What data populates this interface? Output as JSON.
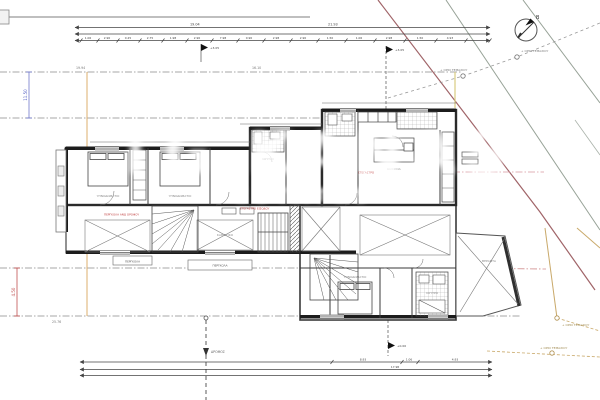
{
  "watermark": {
    "line1": "TG KANAS",
    "line2": "ESTATES"
  },
  "north": {
    "label": "Β"
  },
  "dims_top": {
    "total_left": "19.04",
    "total_right": "21.93",
    "segments": [
      "1.06",
      "2.90",
      "0.25",
      "2.75",
      "1.98",
      "2.90",
      "7.98",
      "0.90",
      "2.98",
      "2.90",
      "1.50",
      "1.06",
      "2.98",
      "1.50",
      "4.93"
    ]
  },
  "dims_bottom": {
    "seg1": "8.93",
    "seg2": "1.06",
    "seg3": "4.93",
    "total": "17.98"
  },
  "dims_side": {
    "blue_left": "11.50",
    "red_left": "4.50",
    "aux1": "19.94",
    "aux2": "16.10",
    "aux3": "25.76"
  },
  "levels": {
    "m1": "+3.05",
    "m2": "+3.05",
    "m3": "+0.00"
  },
  "boundary": {
    "node1": "+ ΟΡΙΟ ΤΕΜΑΧΙΟΥ",
    "node2": "+ ΟΡΙΟ ΤΕΜΑΧΙΟΥ",
    "node3": "+ ΟΡΙΟ ΤΕΜΑΧΙΟΥ",
    "node4": "+ ΟΡΙΟ ΤΕΜΑΧΙΟΥ"
  },
  "road": {
    "label": "ΔΡΟΜΟΣ"
  },
  "pergolas": {
    "p1": "ΠΕΡΓΚΟΛΑ",
    "p2": "ΠΕΡΓΚΟΛΑ"
  },
  "red_notes": {
    "n1": "ΠΕΡΓΚΟΛΑ ΑΝΩ ΟΡΟΦΟΥ",
    "n2": "ΣΤΕΓΑΣΤΡΟ",
    "n3": "ΣΤΕΓΑΣΤΡΟ ΕΙΣΟΔΟΥ"
  },
  "rooms": {
    "r1": "ΥΠΝΟΔΩΜΑΤΙΟ",
    "r2": "ΥΠΝΟΔΩΜΑΤΙΟ",
    "r3": "ΛΟΥΤΡΟ",
    "r4": "ΚΟΥΖΙΝΑ",
    "r5": "ΚΑΘΙΣΤΙΚΟ",
    "r6": "ΥΠΝΟΔΩΜΑΤΙΟ",
    "r7": "ΛΟΥΤΡΟ",
    "r8": "ΒΕΡΑΝΤΑ"
  },
  "colors": {
    "boundary_red": "#a06468",
    "boundary_green": "#97a297",
    "boundary_tan": "#c9a96a",
    "accent_red": "#c04040",
    "accent_blue": "#5560c4",
    "line": "#555555"
  }
}
